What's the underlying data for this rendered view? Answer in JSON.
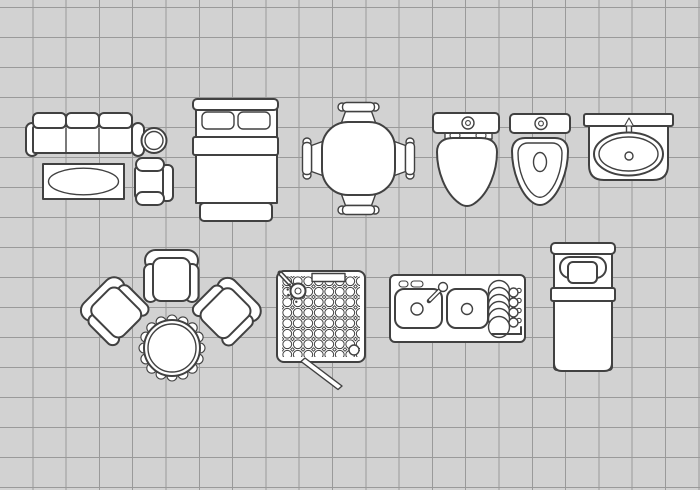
{
  "scene": {
    "title": "Floor plan furniture icons set — top view line drawings on grid paper",
    "type": "floor-plan-icon-sheet",
    "text_content": "none — illustration only, no visible text"
  },
  "canvas": {
    "width": 700,
    "height": 490
  },
  "colors": {
    "background": "#d2d2d2",
    "grid_line": "#9a9a9a",
    "outline": "#414141",
    "fill": "#ffffff"
  },
  "grid": {
    "cell_width": 33.3,
    "cell_height": 30,
    "horizontal_offset_y": 8
  },
  "items": [
    {
      "id": "sofa-three-seat",
      "label": "Three-seat sofa, top view",
      "bbox": {
        "x": 26,
        "y": 113,
        "w": 118,
        "h": 43
      }
    },
    {
      "id": "side-table-round",
      "label": "Small round side table",
      "bbox": {
        "x": 141,
        "y": 127,
        "w": 26,
        "h": 27
      }
    },
    {
      "id": "coffee-table-oval",
      "label": "Rectangular coffee table with oval top",
      "bbox": {
        "x": 43,
        "y": 164,
        "w": 81,
        "h": 35
      }
    },
    {
      "id": "armchair-small",
      "label": "Small armchair facing left",
      "bbox": {
        "x": 135,
        "y": 158,
        "w": 39,
        "h": 47
      }
    },
    {
      "id": "double-bed",
      "label": "Double bed with two pillows and quilt",
      "bbox": {
        "x": 193,
        "y": 99,
        "w": 85,
        "h": 122
      }
    },
    {
      "id": "dining-set",
      "label": "Round dining table with four chairs",
      "bbox": {
        "x": 303,
        "y": 102,
        "w": 111,
        "h": 112
      }
    },
    {
      "id": "toilet-closed",
      "label": "Toilet with closed lid",
      "bbox": {
        "x": 433,
        "y": 113,
        "w": 66,
        "h": 94
      }
    },
    {
      "id": "toilet-open",
      "label": "Toilet with open seat",
      "bbox": {
        "x": 510,
        "y": 113,
        "w": 60,
        "h": 94
      }
    },
    {
      "id": "washbasin",
      "label": "Bathroom washbasin with faucet",
      "bbox": {
        "x": 584,
        "y": 114,
        "w": 89,
        "h": 66
      }
    },
    {
      "id": "lounge-chair-top",
      "label": "Lounge armchair facing down",
      "bbox": {
        "x": 144,
        "y": 249,
        "w": 55,
        "h": 53
      }
    },
    {
      "id": "lounge-chair-left",
      "label": "Lounge armchair rotated toward table",
      "bbox": {
        "x": 85,
        "y": 280,
        "w": 57,
        "h": 60
      }
    },
    {
      "id": "lounge-chair-right",
      "label": "Lounge armchair rotated toward table",
      "bbox": {
        "x": 200,
        "y": 280,
        "w": 57,
        "h": 60
      }
    },
    {
      "id": "table-scalloped",
      "label": "Round table with scalloped cloth edge",
      "bbox": {
        "x": 139,
        "y": 315,
        "w": 66,
        "h": 66
      }
    },
    {
      "id": "shower-cabin",
      "label": "Square shower tray with head, drain, door",
      "bbox": {
        "x": 277,
        "y": 271,
        "w": 88,
        "h": 119
      }
    },
    {
      "id": "kitchen-sink-counter",
      "label": "Kitchen counter, double sink and dish rack",
      "bbox": {
        "x": 390,
        "y": 275,
        "w": 135,
        "h": 67
      }
    },
    {
      "id": "single-bed",
      "label": "Single bed with pillow and striped blanket",
      "bbox": {
        "x": 551,
        "y": 243,
        "w": 64,
        "h": 130
      }
    }
  ]
}
